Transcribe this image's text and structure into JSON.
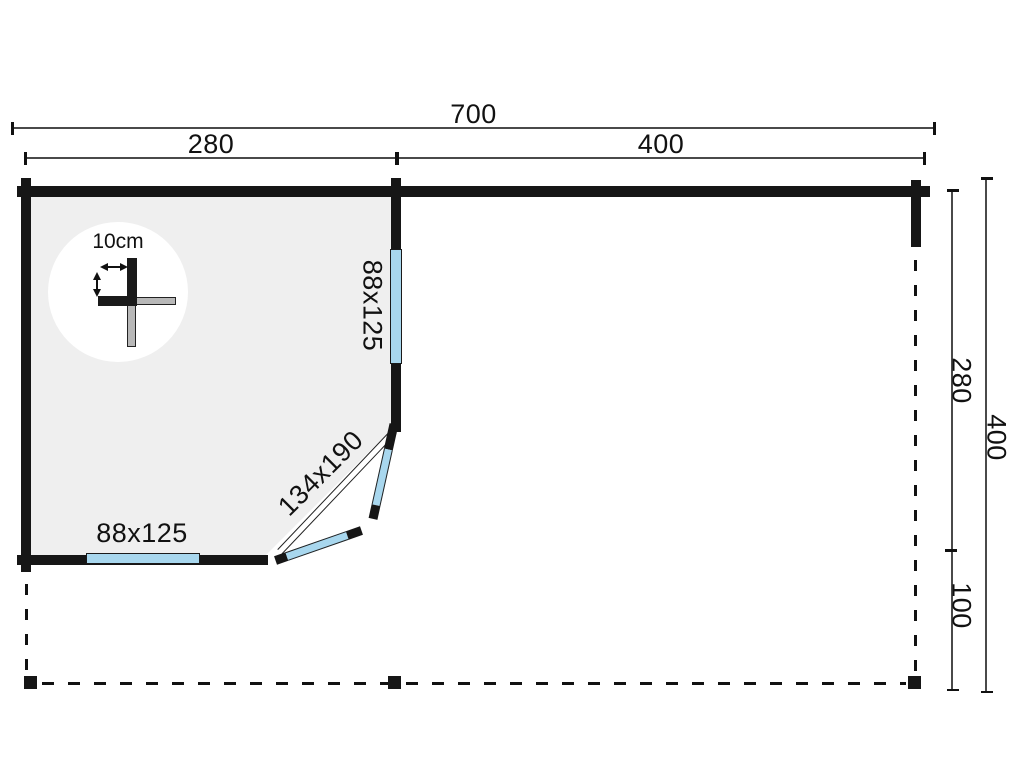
{
  "dimensions": {
    "top_total": "700",
    "top_left_section": "280",
    "top_right_section": "400",
    "right_upper": "280",
    "right_total": "400",
    "right_lower": "100"
  },
  "openings": {
    "right_window": "88x125",
    "bottom_window": "88x125",
    "door": "134x190"
  },
  "detail": {
    "wall_thickness": "10cm"
  },
  "colors": {
    "wall": "#161616",
    "window_glass": "#a8d7ee",
    "room_floor": "#efefef",
    "dimension_line": "#4a4a4a",
    "text": "#111111"
  }
}
